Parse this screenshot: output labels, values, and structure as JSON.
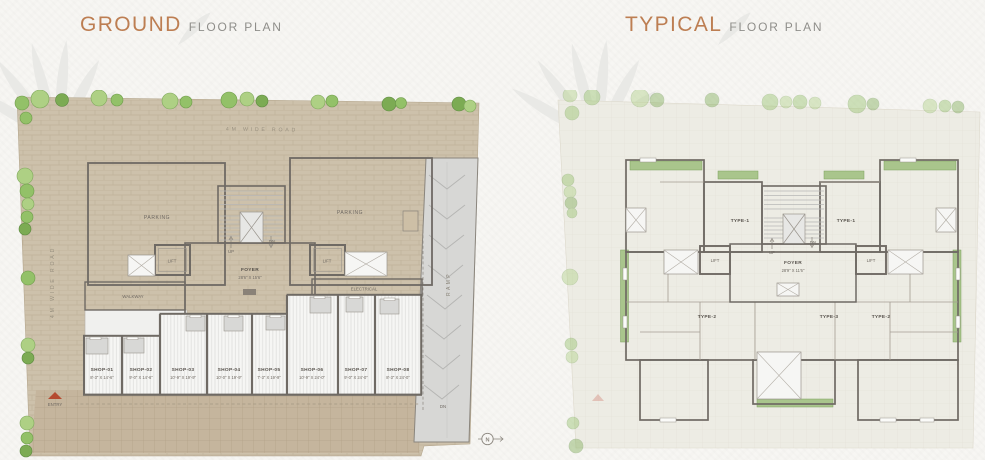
{
  "colors": {
    "paper": "#f7f6f3",
    "title_accent": "#bd7e52",
    "title_sub_gray": "#8f8e8a",
    "plot_tan": "#cdc1ab",
    "plot_tan_dark": "#c3b29a",
    "parking_gray": "#dfdfdd",
    "wall_dark": "#6f6a64",
    "room_beige": "#ded6c7",
    "foyer_gray": "#d6d6d4",
    "balcony_green": "#a9c58c",
    "tree_green": "#93c168",
    "entry_red": "#b54a30"
  },
  "ground_plan": {
    "title_main": "GROUND",
    "title_sub": "FLOOR PLAN",
    "road_top_label": "4M WIDE ROAD",
    "road_left_label": "4M WIDE ROAD",
    "parking_left_label": "PARKING",
    "parking_right_label": "PARKING",
    "lift_left_label": "LIFT",
    "lift_right_label": "LIFT",
    "stair_up_label": "UP",
    "stair_dn_label": "DN",
    "foyer_label": "FOYER",
    "foyer_dim": "28'6\" X 15'6\"",
    "walkway_label": "WALKWAY",
    "electrical_label": "ELECTRICAL",
    "ramp_label": "RAMP",
    "ramp_dn_label": "DN",
    "entry_label": "ENTRY",
    "north_label": "N",
    "shops": [
      {
        "name": "SHOP-01",
        "dim": "8'-3\" X 14'-6\""
      },
      {
        "name": "SHOP-02",
        "dim": "9'-0\" X 14'-6\""
      },
      {
        "name": "SHOP-03",
        "dim": "10'-9\" X 19'-9\""
      },
      {
        "name": "SHOP-04",
        "dim": "10'-0\" X 19'-9\""
      },
      {
        "name": "SHOP-05",
        "dim": "7'-3\" X 19'-9\""
      },
      {
        "name": "SHOP-06",
        "dim": "10'-9\" X 24'-0\""
      },
      {
        "name": "SHOP-07",
        "dim": "9'-0\" X 24'-0\""
      },
      {
        "name": "SHOP-08",
        "dim": "8'-3\" X 24'-0\""
      }
    ]
  },
  "typical_plan": {
    "title_main": "TYPICAL",
    "title_sub": "FLOOR PLAN",
    "unit_type1_label": "TYPE-1",
    "unit_type2_label": "TYPE-2",
    "unit_type3_label": "TYPE-3",
    "lift_label": "LIFT",
    "stair_up_label": "UP",
    "stair_dn_label": "DN",
    "foyer_label": "FOYER",
    "foyer_dim": "28'9\" X 11'6\""
  }
}
